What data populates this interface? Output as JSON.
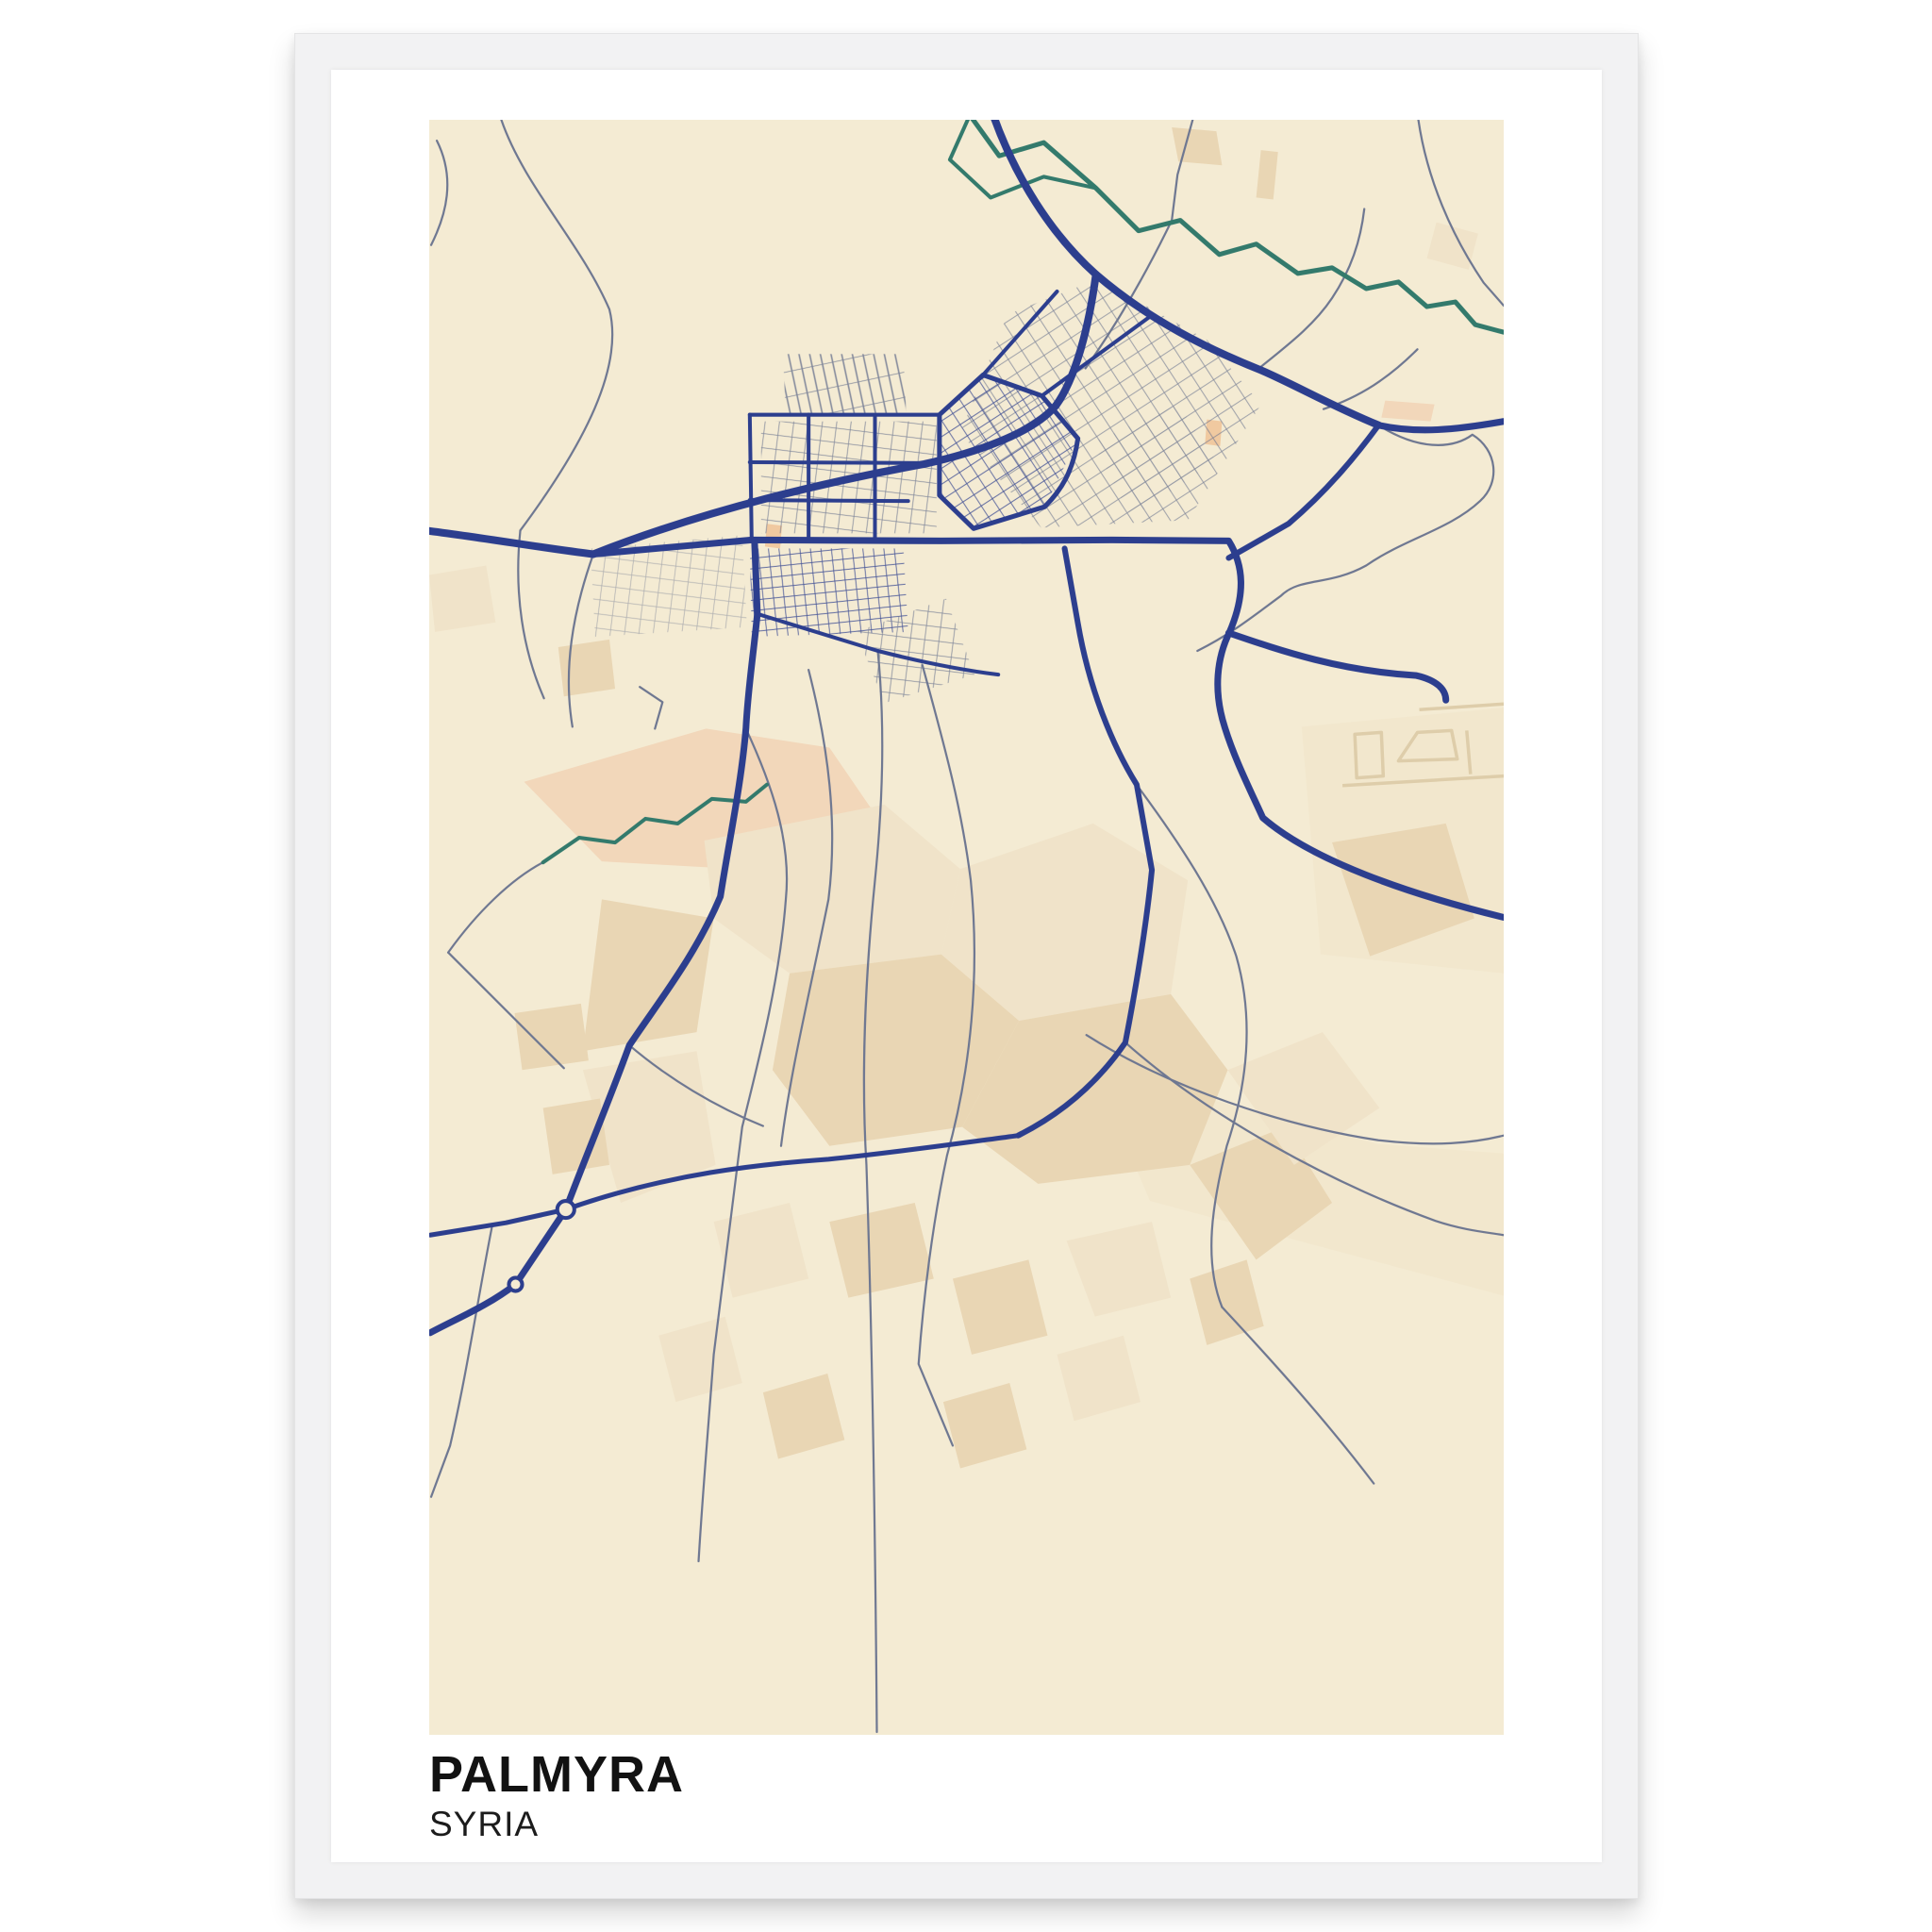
{
  "poster": {
    "title": "PALMYRA",
    "subtitle": "SYRIA"
  },
  "map": {
    "description": "Stylized street map of Palmyra, Syria",
    "features": [
      "highways",
      "city-street-grid",
      "minor-roads",
      "river",
      "stream",
      "oasis-fields",
      "airport",
      "roundabouts"
    ]
  },
  "theme": {
    "page_bg": "#ffffff",
    "frame_color": "#f2f2f3",
    "frame_edge": "#e4e4e5",
    "paper_color": "#ffffff",
    "map_background": "#f4ebd3",
    "road_major": "#2c3e8e",
    "road_minor": "#6e7791",
    "water": "#337a6c",
    "landuse_tan": "#e9d6b4",
    "landuse_light": "#f0e3c9",
    "landuse_salmon": "#f2d7ba",
    "landuse_accent": "#f0c9a0",
    "airport_outline": "#decdaa",
    "title_color": "#121212",
    "subtitle_color": "#1c1c1c"
  }
}
